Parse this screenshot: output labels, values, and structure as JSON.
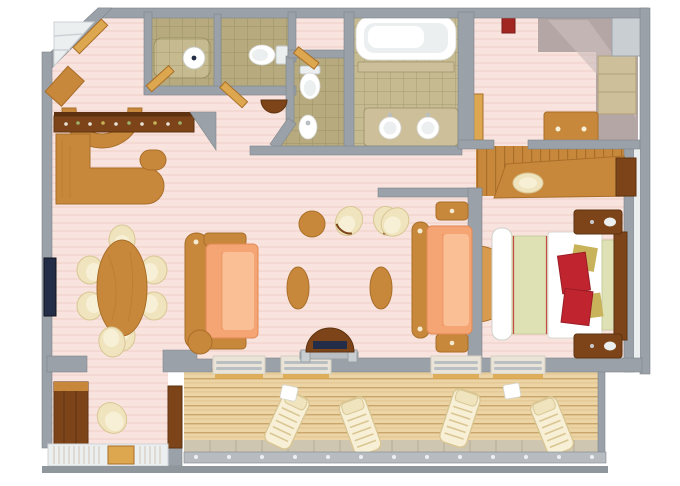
{
  "page": {
    "description": "3D top-down floor plan of a suite with bedroom, living-dining room, wet bar, three bathrooms, walk-in closet, study nook and a long private balcony with loungers",
    "background": "#ffffff"
  },
  "colors": {
    "wall": "#9aa1a8",
    "wallDark": "#7f868c",
    "wallLight": "#c9ced2",
    "carpet": "#f8e3de",
    "carpetStripe": "#f1d3cc",
    "tile": "#b6aa7e",
    "tileGrout": "#9c9066",
    "tileLight": "#c6bb90",
    "deck": "#ecd4a4",
    "deckLine": "#c8a56a",
    "deckBand": "#cfc6b2",
    "wood": "#c8883c",
    "woodLight": "#d79a4e",
    "woodDark": "#a96e28",
    "walnut": "#7c4418",
    "walnutDark": "#5e3210",
    "doorWood": "#dca74e",
    "cream": "#efe4bd",
    "creamInner": "#f8f0d6",
    "creamShadow": "#d9c693",
    "peach": "#f5a474",
    "peachLight": "#fbbf95",
    "peachDark": "#e18a55",
    "white": "#ffffff",
    "offWhite": "#eceff0",
    "sage": "#dee1b4",
    "red": "#c0252f",
    "gold": "#c8b35a",
    "mauve": "#b5a6a6",
    "mauveLight": "#cbbdbb",
    "navy": "#232d47",
    "chrome": "#b9bec2",
    "stone": "#cdbf9a",
    "trackBase": "#eae4d8",
    "rail": "#b7bcc1",
    "railDark": "#8f969c"
  },
  "rooms": [
    "entry-foyer",
    "guest-shower-room",
    "guest-toilet-room",
    "second-bathroom",
    "master-bathroom",
    "walk-in-closet",
    "wet-bar",
    "dining-area",
    "living-area",
    "bedroom",
    "bedroom-vestibule",
    "study-nook",
    "balcony"
  ],
  "furniture": [
    "bar-counter",
    "dining-table",
    "dining-chair",
    "sofa",
    "tub-chair",
    "coffee-table",
    "round-side-table",
    "tv",
    "king-bed",
    "nightstand",
    "vanity-console",
    "vanity-stool",
    "bathtub",
    "double-sink-vanity",
    "toilet",
    "bidet",
    "shower-drain",
    "closet-dresser",
    "deck-lounger",
    "deck-side-table",
    "glass-railing",
    "sliding-door-track"
  ],
  "counts": {
    "deck_loungers": 4,
    "dining_chairs": 6,
    "sofas": 2,
    "coffee_tables": 2,
    "toilets": 2,
    "sinks": 2
  }
}
